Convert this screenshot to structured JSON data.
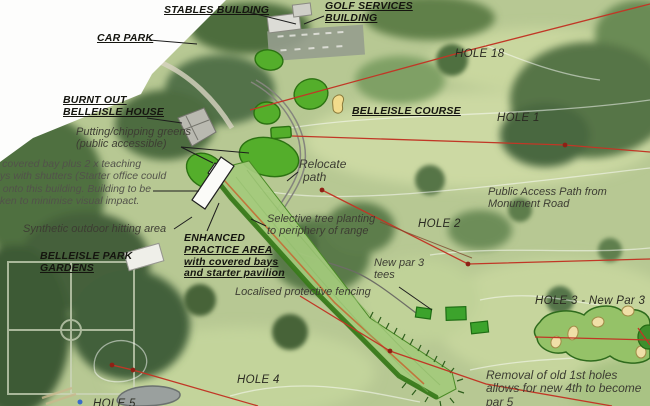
{
  "map": {
    "title": "Belleisle golf course masterplan (annotated aerial)",
    "labels": {
      "stables_building": "STABLES BUILDING",
      "golf_services_building": [
        "GOLF SERVICES",
        "BUILDING"
      ],
      "car_park": "CAR PARK",
      "burnt_out_house": [
        "BURNT OUT",
        "BELLEISLE HOUSE"
      ],
      "putting_greens": [
        "Putting/chipping greens",
        "(public accessible)"
      ],
      "covered_bay_note": [
        "x covered bay plus 2 x teaching",
        "ays with shutters (Starter office could",
        "g onto this building. Building to be",
        "nken to minimise visual impact."
      ],
      "synthetic_area": "Synthetic outdoor hitting area",
      "belleisle_course": "BELLEISLE COURSE",
      "hole_18": "HOLE 18",
      "hole_1": "HOLE 1",
      "relocate_path": [
        "Relocate",
        "path"
      ],
      "public_access_path": [
        "Public Access Path from",
        "Monument Road"
      ],
      "hole_2": "HOLE 2",
      "selective_planting": [
        "Selective tree planting",
        "to periphery of range"
      ],
      "enhanced_practice_area": [
        "ENHANCED",
        "PRACTICE AREA",
        "with covered bays",
        "and starter pavilion"
      ],
      "park_gardens": [
        "BELLEISLE PARK",
        "GARDENS"
      ],
      "new_par3_tees": [
        "New par 3",
        "tees"
      ],
      "localised_fencing": "Localised protective fencing",
      "hole_3": "HOLE 3 - New Par 3",
      "removal_note": [
        "Removal of old 1st holes",
        "allows for new 4th to become",
        "par 5"
      ],
      "hole_4": "HOLE 4",
      "hole_5": "HOLE 5"
    },
    "colors": {
      "hole_line_red": "#c13726",
      "overlay_green_bright": "#54ae2b",
      "range_fill_green": "#a4ca7c",
      "range_edge_dark_green": "#3a7a1c",
      "range_orange_line": "#c0763c",
      "tee_box_green": "#3ca32c",
      "new_green_fill": "#95c268",
      "bunker_sand": "#f0dfa7",
      "path_grey": "#85857d",
      "pond_grey": "#9aa09e",
      "page_white": "#ffffff"
    }
  }
}
